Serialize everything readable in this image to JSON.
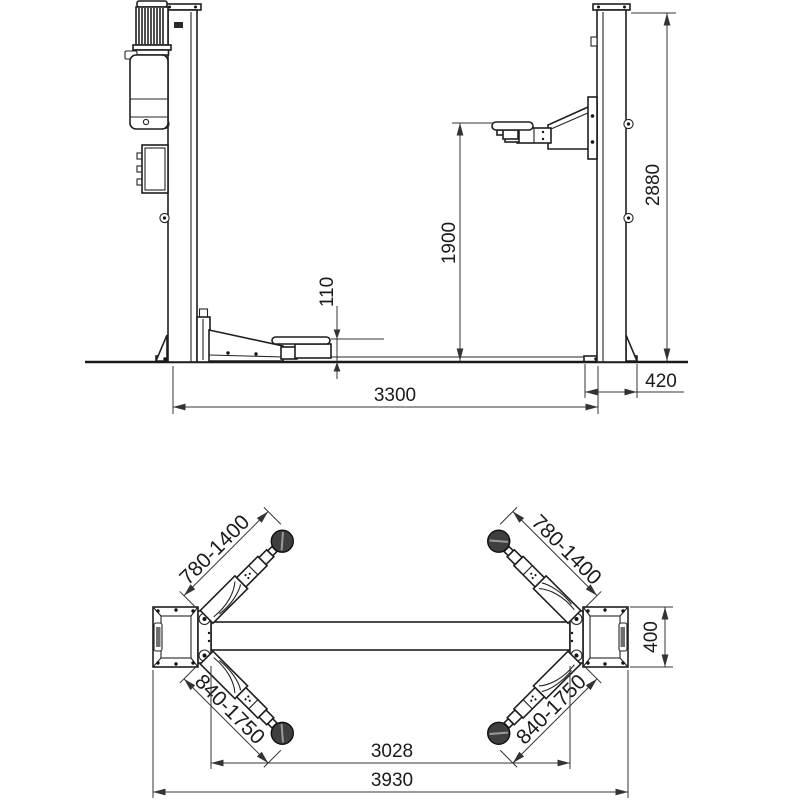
{
  "front_view": {
    "overall_height": "2880",
    "max_lifting_height": "1900",
    "min_pad_height": "110",
    "column_distance": "3300",
    "base_plate_width": "420"
  },
  "plan_view": {
    "front_arm_reach_left": "780-1400",
    "front_arm_reach_right": "780-1400",
    "rear_arm_reach_left": "840-1750",
    "rear_arm_reach_right": "840-1750",
    "inner_distance": "3028",
    "overall_width": "3930",
    "base_plate_depth": "400"
  }
}
